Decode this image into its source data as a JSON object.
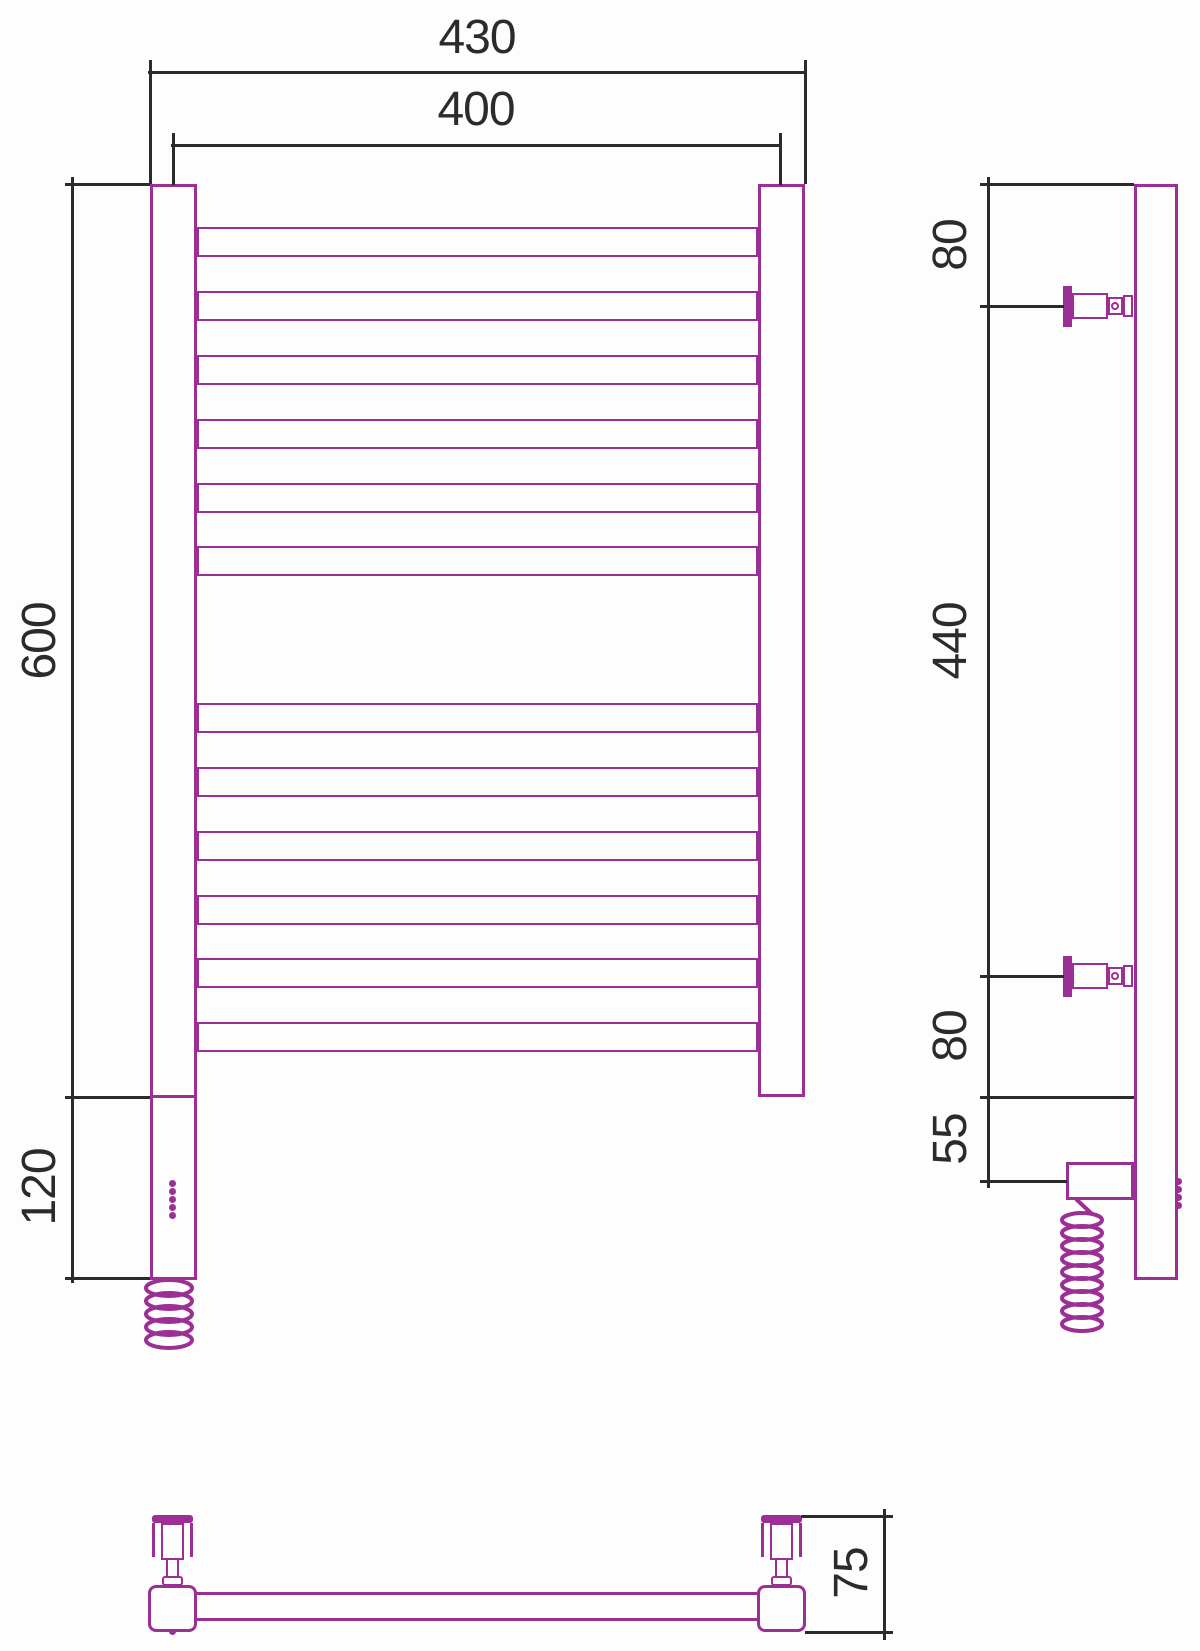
{
  "drawing": {
    "colors": {
      "outline": "#9C2F95",
      "dimension": "#2B2B2B",
      "background": "#FDFDFD"
    },
    "front_view": {
      "tube_count": 12,
      "dims": {
        "overall_width": "430",
        "tube_width": "400",
        "height": "600",
        "heater_section_height": "120"
      }
    },
    "side_view": {
      "dims": {
        "top_to_upper_bracket": "80",
        "upper_to_lower_bracket": "440",
        "lower_bracket_to_bottom": "80",
        "bottom_to_cable_axis": "55"
      }
    },
    "top_view": {
      "dims": {
        "wall_to_front": "75"
      }
    }
  }
}
